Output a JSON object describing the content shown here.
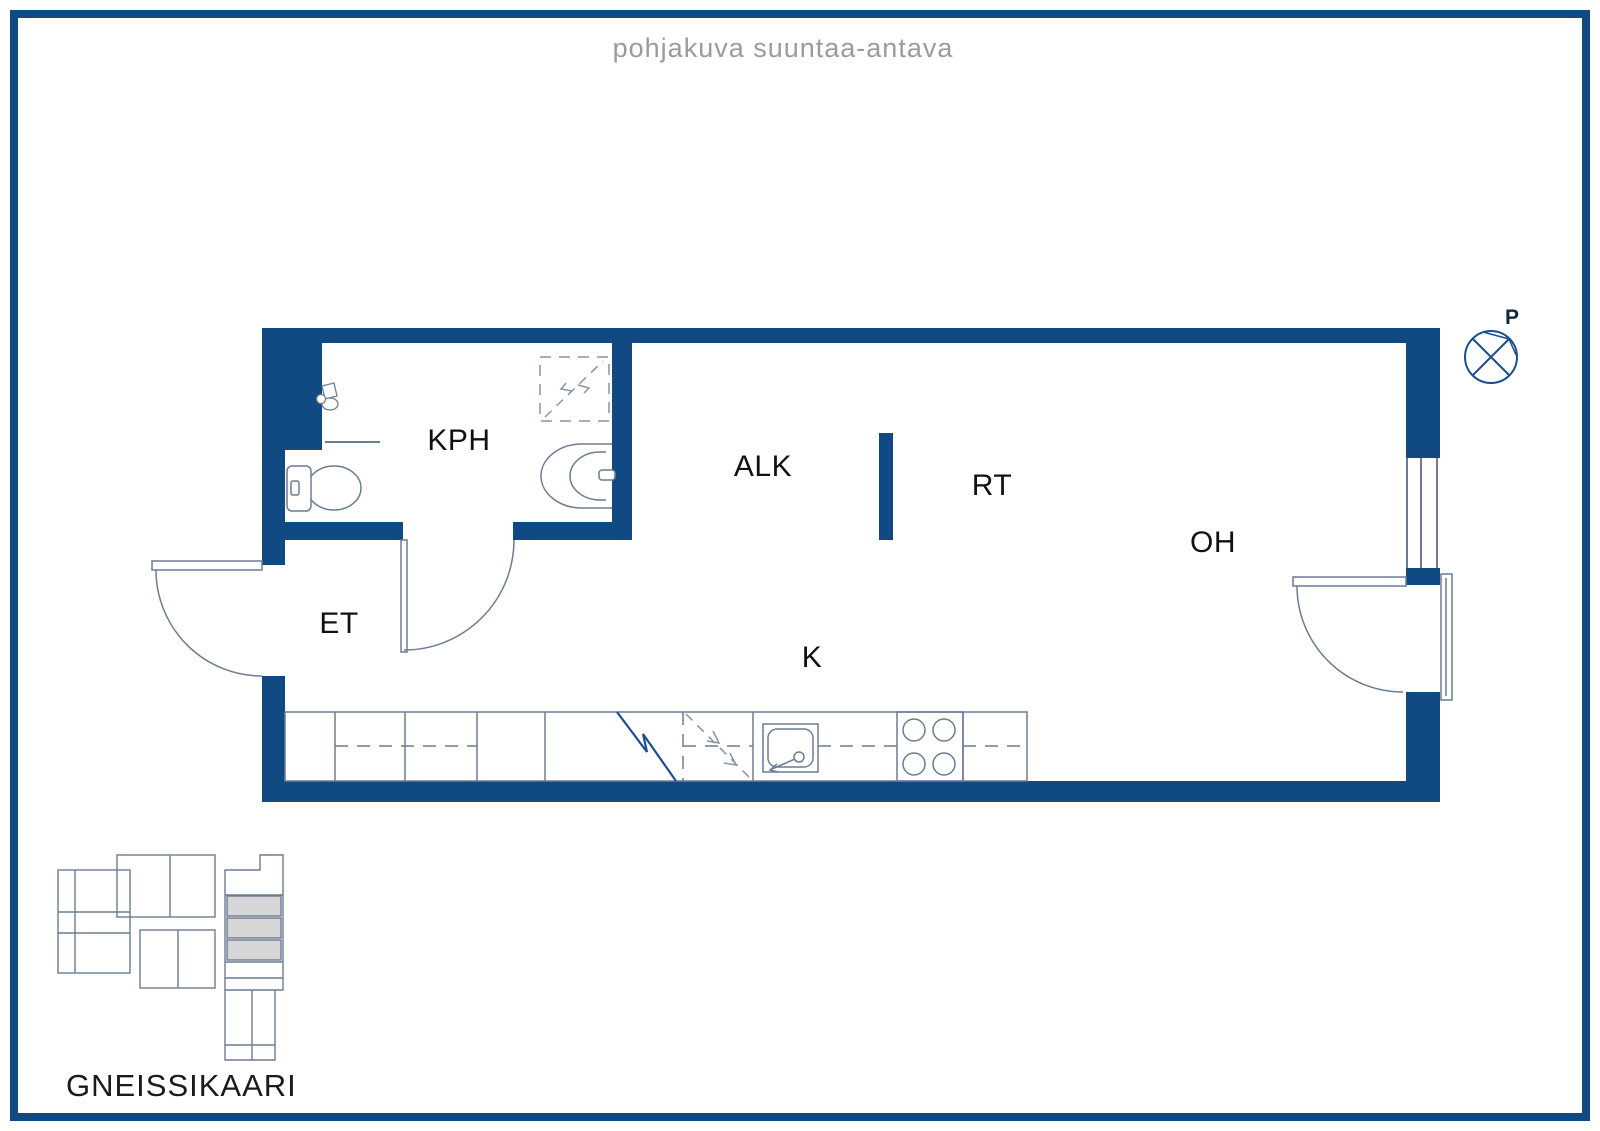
{
  "page": {
    "title": "pohjakuva suuntaa-antava"
  },
  "plan": {
    "rooms": [
      {
        "id": "kph",
        "label": "KPH"
      },
      {
        "id": "alk",
        "label": "ALK"
      },
      {
        "id": "rt",
        "label": "RT"
      },
      {
        "id": "oh",
        "label": "OH"
      },
      {
        "id": "et",
        "label": "ET"
      },
      {
        "id": "k",
        "label": "K"
      }
    ],
    "compass_label": "P",
    "doors": [
      "entrance-door",
      "bathroom-door",
      "balcony-door"
    ],
    "window_count": 1,
    "fixtures": [
      "toilet",
      "washbasin",
      "mixer-tap",
      "shower-reservation",
      "kitchen-sink",
      "stove",
      "fridge-break-line",
      "appliance-reservation"
    ]
  },
  "site_plan": {
    "street_name": "GNEISSIKAARI"
  },
  "colors": {
    "wall": "#114a83",
    "fixture_line": "#6b7c94",
    "accent_line": "#1b4f94",
    "highlight_fill": "#d6d6d6",
    "title_text": "#9b9b9b",
    "label_text": "#111111"
  }
}
